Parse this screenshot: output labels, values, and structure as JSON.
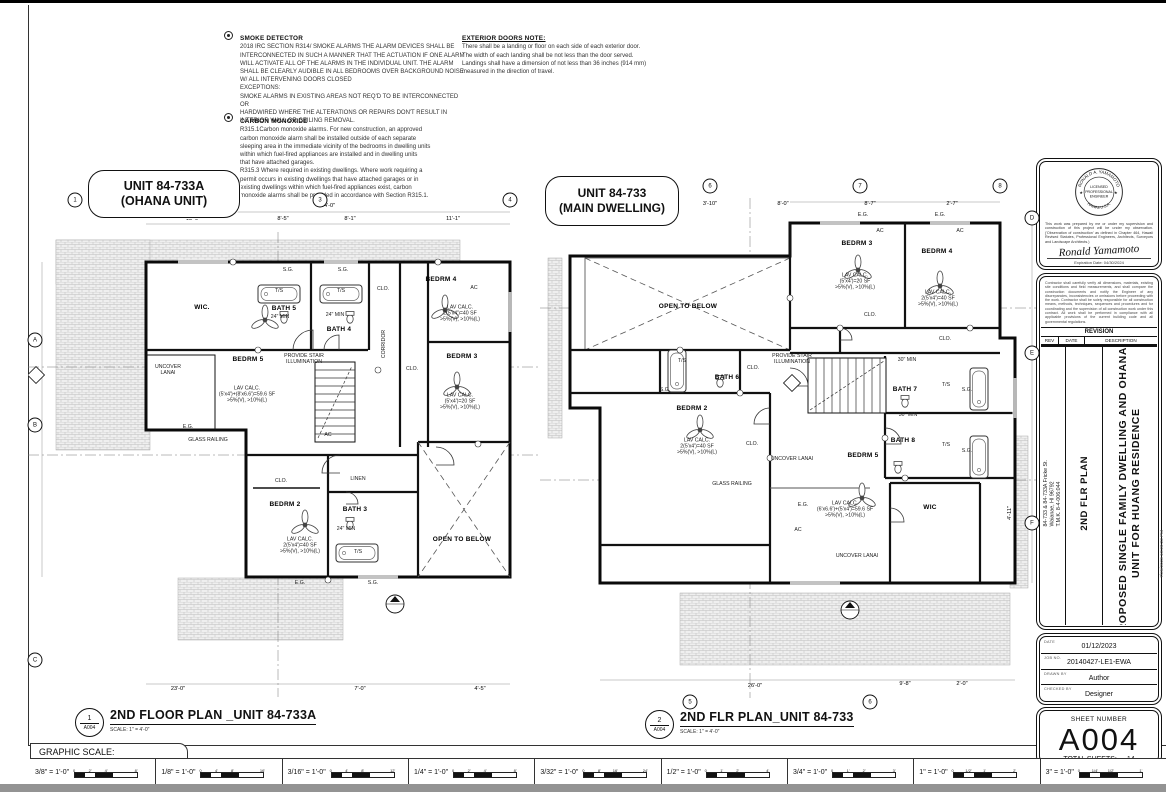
{
  "notes": {
    "smoke": {
      "title": "SMOKE DETECTOR",
      "body": "2018 IRC SECTION R314/ SMOKE ALARMS THE ALARM DEVICES SHALL BE\nINTERCONNECTED IN SUCH A MANNER THAT THE ACTUATION IF ONE ALARM\nWILL ACTIVATE ALL OF THE ALARMS IN THE INDIVIDUAL UNIT. THE ALARM\nSHALL BE CLEARLY AUDIBLE IN ALL BEDROOMS OVER BACKGROUND NOISE\nW/ ALL INTERVENING DOORS CLOSED\nEXCEPTIONS:\nSMOKE ALARMS IN EXISTING AREAS NOT REQ'D TO BE INTERCONNECTED OR\nHARDWIRED WHERE THE ALTERATIONS OR REPAIRS DON'T RESULT IN\nINTERIOR WALL OR CEILING REMOVAL."
    },
    "carbon": {
      "title": "CARBON MONOXIDE",
      "body": "R315.1Carbon monoxide alarms. For new construction, an approved\ncarbon monoxide alarm shall be installed outside of each separate\nsleeping area in the immediate vicinity of the bedrooms in dwelling units\nwithin which fuel-fired appliances are installed and in dwelling units\nthat have attached garages.\nR315.3 Where required in existing dwellings. Where work requiring a\npermit occurs in existing dwellings that have attached garages or in\nexisting dwellings within which fuel-fired appliances exist, carbon\nmonoxide alarms shall be provided in accordance with Section R315.1."
    },
    "exterior": {
      "title": "EXTERIOR DOORS NOTE:",
      "body": "There shall be a landing or floor on each side of each exterior door.\nThe width of each landing shall be not less than the door served.\nLandings shall have a dimension of not less than 36 inches (914 mm)\nmeasured in the direction of travel."
    }
  },
  "plan1": {
    "bubble": "UNIT 84-733A\n(OHANA UNIT)",
    "title_num": "1",
    "title_sheet": "A004",
    "title": "2ND FLOOR PLAN _UNIT 84-733A",
    "scale_note": "SCALE: 1\" = 4'-0\"",
    "labels": [
      {
        "t": "WIC.",
        "x": 174,
        "y": 116,
        "c": "rm"
      },
      {
        "t": "T/S",
        "x": 251,
        "y": 99
      },
      {
        "t": "T/S",
        "x": 313,
        "y": 99
      },
      {
        "t": "BATH 5",
        "x": 256,
        "y": 117,
        "c": "rm"
      },
      {
        "t": "24\" MIN",
        "x": 252,
        "y": 125
      },
      {
        "t": "24\" MIN",
        "x": 307,
        "y": 123
      },
      {
        "t": "BATH 4",
        "x": 311,
        "y": 138,
        "c": "rm"
      },
      {
        "t": "S.G.",
        "x": 260,
        "y": 78
      },
      {
        "t": "S.G.",
        "x": 315,
        "y": 78
      },
      {
        "t": "BEDRM 4",
        "x": 413,
        "y": 88,
        "c": "rm"
      },
      {
        "t": "LAV CALC.\n2(5'x4')=40 SF\n>5%(V), >10%(L)",
        "x": 432,
        "y": 122
      },
      {
        "t": "CLO.",
        "x": 355,
        "y": 97
      },
      {
        "t": "CORRIDOR",
        "x": 356,
        "y": 152,
        "c": "rot"
      },
      {
        "t": "CLO.",
        "x": 384,
        "y": 177
      },
      {
        "t": "BEDRM 3",
        "x": 434,
        "y": 165,
        "c": "rm"
      },
      {
        "t": "LAV CALC.\n(5'x4')=20 SF\n>5%(V), >10%(L)",
        "x": 432,
        "y": 210
      },
      {
        "t": "UNCOVER\nLANAI",
        "x": 140,
        "y": 178
      },
      {
        "t": "BEDRM 5",
        "x": 220,
        "y": 168,
        "c": "rm"
      },
      {
        "t": "PROVIDE STAIR\nILLUMINATION",
        "x": 276,
        "y": 167
      },
      {
        "t": "LAV CALC.\n(5'x4')+(8'x6.6')=59.6 SF\n>5%(V), >10%(L)",
        "x": 219,
        "y": 203
      },
      {
        "t": "GLASS RAILING",
        "x": 180,
        "y": 248
      },
      {
        "t": "E.G.",
        "x": 160,
        "y": 235
      },
      {
        "t": "CLO.",
        "x": 253,
        "y": 289
      },
      {
        "t": "LINEN",
        "x": 330,
        "y": 287
      },
      {
        "t": "BEDRM 2",
        "x": 257,
        "y": 313,
        "c": "rm"
      },
      {
        "t": "BATH 3",
        "x": 327,
        "y": 318,
        "c": "rm"
      },
      {
        "t": "24\" MIN",
        "x": 318,
        "y": 337
      },
      {
        "t": "T/S",
        "x": 330,
        "y": 360
      },
      {
        "t": "LAV CALC.\n2(5'x4')=40 SF\n>5%(V), >10%(L)",
        "x": 272,
        "y": 354
      },
      {
        "t": "OPEN TO BELOW",
        "x": 434,
        "y": 348,
        "c": "rm"
      },
      {
        "t": "E.G.",
        "x": 272,
        "y": 391
      },
      {
        "t": "S.G.",
        "x": 345,
        "y": 391
      },
      {
        "t": "AC",
        "x": 300,
        "y": 243
      },
      {
        "t": "AC",
        "x": 446,
        "y": 96
      }
    ],
    "dims": [
      {
        "t": "54'-0\"",
        "x": 300,
        "y": 14,
        "c": "dim"
      },
      {
        "t": "13'-9\"",
        "x": 165,
        "y": 27,
        "c": "dim"
      },
      {
        "t": "8'-5\"",
        "x": 255,
        "y": 27,
        "c": "dim"
      },
      {
        "t": "8'-1\"",
        "x": 322,
        "y": 27,
        "c": "dim"
      },
      {
        "t": "11'-1\"",
        "x": 425,
        "y": 27,
        "c": "dim"
      },
      {
        "t": "23'-0\"",
        "x": 150,
        "y": 497,
        "c": "dim"
      },
      {
        "t": "7'-0\"",
        "x": 332,
        "y": 497,
        "c": "dim"
      },
      {
        "t": "4'-5\"",
        "x": 452,
        "y": 497,
        "c": "dim"
      }
    ],
    "bubbles": [
      {
        "t": "1",
        "x": 47,
        "y": 8
      },
      {
        "t": "2",
        "x": 202,
        "y": 8
      },
      {
        "t": "3",
        "x": 292,
        "y": 8
      },
      {
        "t": "4",
        "x": 482,
        "y": 8
      },
      {
        "t": "A",
        "x": 7,
        "y": 148
      },
      {
        "t": "B",
        "x": 7,
        "y": 233
      },
      {
        "t": "C",
        "x": 7,
        "y": 468
      }
    ]
  },
  "plan2": {
    "bubble": "UNIT 84-733\n(MAIN DWELLING)",
    "title_num": "2",
    "title_sheet": "A004",
    "title": "2ND FLR PLAN_UNIT 84-733",
    "scale_note": "SCALE: 1\" = 4'-0\"",
    "labels": [
      {
        "t": "E.G.",
        "x": 323,
        "y": 37
      },
      {
        "t": "E.G.",
        "x": 400,
        "y": 37
      },
      {
        "t": "AC",
        "x": 340,
        "y": 53
      },
      {
        "t": "AC",
        "x": 420,
        "y": 53
      },
      {
        "t": "BEDRM 3",
        "x": 317,
        "y": 66,
        "c": "rm"
      },
      {
        "t": "LAV CALC.\n(5'x4')=20 SF\n>5%(V), >10%(L)",
        "x": 315,
        "y": 104
      },
      {
        "t": "BEDRM 4",
        "x": 397,
        "y": 74,
        "c": "rm"
      },
      {
        "t": "LAV CALC.\n2(5'x4')=40 SF\n>5%(V), >10%(L)",
        "x": 398,
        "y": 121
      },
      {
        "t": "OPEN TO BELOW",
        "x": 148,
        "y": 129,
        "c": "rm"
      },
      {
        "t": "CLO.",
        "x": 330,
        "y": 137
      },
      {
        "t": "CLO.",
        "x": 405,
        "y": 161
      },
      {
        "t": "T/S",
        "x": 142,
        "y": 183
      },
      {
        "t": "S.G.",
        "x": 125,
        "y": 212
      },
      {
        "t": "BATH 6",
        "x": 187,
        "y": 200,
        "c": "rm"
      },
      {
        "t": "CLO.",
        "x": 213,
        "y": 190
      },
      {
        "t": "PROVIDE STAIR\nILLUMINATION",
        "x": 252,
        "y": 181
      },
      {
        "t": "30\" MIN",
        "x": 367,
        "y": 182
      },
      {
        "t": "BATH 7",
        "x": 365,
        "y": 212,
        "c": "rm"
      },
      {
        "t": "T/S",
        "x": 406,
        "y": 207
      },
      {
        "t": "S.G.",
        "x": 427,
        "y": 212
      },
      {
        "t": "BEDRM 2",
        "x": 152,
        "y": 231,
        "c": "rm"
      },
      {
        "t": "LAV CALC.\n2(5'x4')=40 SF\n>5%(V), >10%(L)",
        "x": 157,
        "y": 269
      },
      {
        "t": "CLO.",
        "x": 212,
        "y": 266
      },
      {
        "t": "UNCOVER LANAI",
        "x": 252,
        "y": 281
      },
      {
        "t": "30\" MIN",
        "x": 368,
        "y": 237
      },
      {
        "t": "BATH 8",
        "x": 363,
        "y": 263,
        "c": "rm"
      },
      {
        "t": "T/S",
        "x": 406,
        "y": 267
      },
      {
        "t": "S.G.",
        "x": 427,
        "y": 273
      },
      {
        "t": "BEDRM 5",
        "x": 323,
        "y": 278,
        "c": "rm"
      },
      {
        "t": "GLASS RAILING",
        "x": 192,
        "y": 306
      },
      {
        "t": "LAV CALC.\n(6'x6.6')+(5'x4')=59.6 SF\n>5%(V), >10%(L)",
        "x": 305,
        "y": 332
      },
      {
        "t": "WIC",
        "x": 390,
        "y": 330,
        "c": "rm"
      },
      {
        "t": "UNCOVER LANAI",
        "x": 317,
        "y": 378
      },
      {
        "t": "E.G.",
        "x": 263,
        "y": 327
      },
      {
        "t": "AC",
        "x": 258,
        "y": 352
      }
    ],
    "dims": [
      {
        "t": "3'-10\"",
        "x": 170,
        "y": 26,
        "c": "dim"
      },
      {
        "t": "8'-0\"",
        "x": 243,
        "y": 26,
        "c": "dim"
      },
      {
        "t": "8'-7\"",
        "x": 330,
        "y": 26,
        "c": "dim"
      },
      {
        "t": "2'-7\"",
        "x": 412,
        "y": 26,
        "c": "dim"
      },
      {
        "t": "26'-0\"",
        "x": 215,
        "y": 508,
        "c": "dim"
      },
      {
        "t": "9'-8\"",
        "x": 365,
        "y": 506,
        "c": "dim"
      },
      {
        "t": "2'-0\"",
        "x": 422,
        "y": 506,
        "c": "dim"
      },
      {
        "t": "4'-11\"",
        "x": 470,
        "y": 335,
        "c": "rot dim"
      }
    ],
    "bubbles": [
      {
        "t": "5",
        "x": 60,
        "y": 8
      },
      {
        "t": "6",
        "x": 170,
        "y": 8
      },
      {
        "t": "7",
        "x": 320,
        "y": 8
      },
      {
        "t": "8",
        "x": 460,
        "y": 8
      },
      {
        "t": "5",
        "x": 150,
        "y": 524
      },
      {
        "t": "6",
        "x": 330,
        "y": 524
      },
      {
        "t": "D",
        "x": 492,
        "y": 40
      },
      {
        "t": "E",
        "x": 492,
        "y": 175
      },
      {
        "t": "F",
        "x": 492,
        "y": 345
      }
    ]
  },
  "titleblock": {
    "stamp": {
      "arc_top": "RONALD A. YAMAMOTO",
      "arc_bottom": "HAWAII U.S.A.",
      "center1": "LICENSED",
      "center2": "PROFESSIONAL",
      "center3": "ENGINEER",
      "cert": "This work was prepared by me or under my supervision and construction of this project will be under my observation. ('Observation of construction' as defined in Chapter 464, Hawaii Revised Statutes, Professional Engineers, Architects, Surveyors and Landscape Architects.)",
      "signature": "Ronald Yamamoto",
      "expiration": "Expiration Date: 04/30/2024"
    },
    "general_note": "Contractor shall carefully verify all dimensions, materials, existing site conditions and field measurements, and shall compare the construction documents and notify the Engineer of any discrepancies, inconsistencies or omissions before proceeding with the work. Contractor shall be solely responsible for all construction means, methods, techniques, sequences and procedures and for coordinating and the supervision of all construction work under this contract. All work shall be performed in compliance with all applicable provisions of the current building code and all governmental regulations.",
    "revision_title": "REVISION",
    "rev_col1": "REV",
    "rev_col2": "DATE",
    "rev_col3": "DESCRIPTION",
    "sheet_name": "2ND FLR PLAN",
    "address": "84-733 & 84-733A Fricke St.\nWaianae, HI 96792\nT.M.K. 8-4-006:044",
    "project_title": "PROPOSED SINGLE FAMILY DWELLING AND OHANA\nUNIT FOR HUANG RESIDENCE",
    "info": [
      {
        "label": "DATE",
        "value": "01/12/2023"
      },
      {
        "label": "JOB NO.",
        "value": "20140427-LE1-EWA"
      },
      {
        "label": "DRAWN BY",
        "value": "Author"
      },
      {
        "label": "CHECKED BY",
        "value": "Designer"
      }
    ],
    "sheet_number_label": "SHEET NUMBER",
    "sheet_number": "A004",
    "total_sheets_label": "TOTAL SHEETS:",
    "total_sheets": "14",
    "side_text": "7/26/2023 10:20:22 PM"
  },
  "footer": {
    "graphic_scale_label": "GRAPHIC SCALE:",
    "scales": [
      {
        "label": "3/8\" = 1'-0\"",
        "ticks": [
          "0",
          "2'",
          "4'",
          "8'"
        ]
      },
      {
        "label": "1/8\" = 1'-0\"",
        "ticks": [
          "0",
          "4'",
          "8'",
          "16'"
        ]
      },
      {
        "label": "3/16\" = 1'-0\"",
        "ticks": [
          "0",
          "4'",
          "8'",
          "12'"
        ]
      },
      {
        "label": "1/4\" = 1'-0\"",
        "ticks": [
          "0",
          "2'",
          "4'",
          "8'"
        ]
      },
      {
        "label": "3/32\" = 1'-0\"",
        "ticks": [
          "0",
          "8'",
          "16'",
          "24'"
        ]
      },
      {
        "label": "1/2\" = 1'-0\"",
        "ticks": [
          "0",
          "1'",
          "2'",
          "4'"
        ]
      },
      {
        "label": "3/4\" = 1'-0\"",
        "ticks": [
          "0",
          "1'",
          "2'",
          "3'"
        ]
      },
      {
        "label": "1\" = 1'-0\"",
        "ticks": [
          "0",
          "1/2'",
          "1'",
          "2'"
        ]
      },
      {
        "label": "3\" = 1'-0\"",
        "ticks": [
          "0",
          "1/4'",
          "1/2'",
          "1'"
        ]
      }
    ]
  }
}
